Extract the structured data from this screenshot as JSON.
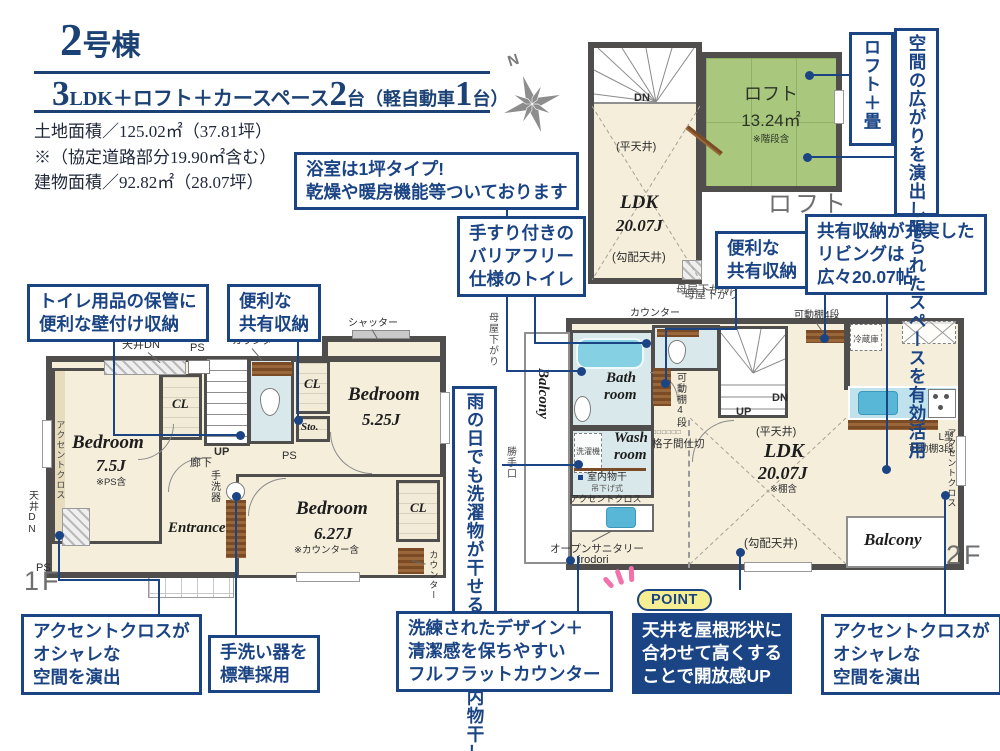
{
  "header": {
    "building_num": "2",
    "building_suffix": "号棟",
    "plan_n1": "3",
    "plan_t1": "LDK＋ロフト＋カースペース",
    "plan_n2": "2",
    "plan_t2": "台（軽自動車",
    "plan_n3": "1",
    "plan_t3": "台）",
    "land_area": "土地面積／125.02㎡（37.81坪）",
    "land_note": "※（協定道路部分19.90㎡含む）",
    "building_area": "建物面積／92.82㎡（28.07坪）"
  },
  "compass": {
    "north": "N"
  },
  "callouts": {
    "bath": {
      "l1": "浴室は1坪タイプ!",
      "l2": "乾燥や暖房機能等ついております"
    },
    "barrier_free": {
      "l1": "手すり付きの",
      "l2": "バリアフリー",
      "l3": "仕様のトイレ"
    },
    "wall_storage": {
      "l1": "トイレ用品の保管に",
      "l2": "便利な壁付け収納"
    },
    "shared_1f": {
      "l1": "便利な",
      "l2": "共有収納"
    },
    "shared_2f": {
      "l1": "便利な",
      "l2": "共有収納"
    },
    "living": {
      "l1": "共有収納が充実した",
      "l2": "リビングは",
      "l3": "広々20.07帖"
    },
    "loft_tatami": {
      "text": "ロフト＋畳"
    },
    "space": {
      "text": "空間の広がりを演出し限られたスペースを有効活用"
    },
    "laundry": {
      "text": "雨の日でも洗濯物が干せる便利な室内物干し"
    },
    "accent_1f": {
      "l1": "アクセントクロスが",
      "l2": "オシャレな",
      "l3": "空間を演出"
    },
    "handwash": {
      "l1": "手洗い器を",
      "l2": "標準採用"
    },
    "flat_counter": {
      "l1": "洗練されたデザイン＋",
      "l2": "清潔感を保ちやすい",
      "l3": "フルフラットカウンター"
    },
    "point": {
      "badge": "POINT",
      "l1": "天井を屋根形状に",
      "l2": "合わせて高くする",
      "l3": "ことで開放感UP"
    },
    "accent_2f": {
      "l1": "アクセントクロスが",
      "l2": "オシャレな",
      "l3": "空間を演出"
    }
  },
  "loft": {
    "dn": "DN",
    "name": "ロフト",
    "area": "13.24㎡",
    "note": "※階段含",
    "flat_ceiling": "(平天井)",
    "ldk": "LDK",
    "ldk_size": "20.07J",
    "slope_ceiling": "(勾配天井)",
    "moyasagari": "母屋下がり",
    "floor_name": "ロフト"
  },
  "f2": {
    "moya_left": "母屋下がり",
    "moya_top": "母屋下がり",
    "katteguchi": "勝手口",
    "balcony_left": "Balcony",
    "bath_l1": "Bath",
    "bath_l2": "room",
    "washer": "洗濯機",
    "wash_l1": "Wash",
    "wash_l2": "room",
    "monohoshi": "室内物干",
    "tsurisage": "吊下げ式",
    "accent_wash": "アクセントクロス",
    "open_sanitary": "オープンサニタリー",
    "irodori": "irodori",
    "counter": "カウンター",
    "kadoudana4_1": "可動棚4段",
    "kadoudana4_2": "可動棚4段",
    "koushi_dots": "□□□□□□",
    "koushi": "格子間仕切",
    "up": "UP",
    "dn": "DN",
    "flat_ceiling": "(平天井)",
    "ldk": "LDK",
    "ldk_size": "20.07J",
    "ldk_note": "※棚含",
    "slope_ceiling": "(勾配天井)",
    "fridge": "冷蔵庫",
    "lshelf_l1": "L型",
    "lshelf_l2": "可動棚3段",
    "accent_right": "アクセントクロス",
    "balcony_bottom": "Balcony",
    "floor_name": "2F"
  },
  "f1": {
    "ceiling_dn_top": "天井DN",
    "ps_top": "PS",
    "counter_top": "カウンター",
    "shutter": "シャッター",
    "cl1": "CL",
    "cl2": "CL",
    "cl3": "CL",
    "sto": "Sto.",
    "bed1": "Bedroom",
    "bed1_size": "7.5J",
    "bed1_note": "※PS含",
    "accent": "アクセントクロス",
    "ceiling_dn_left": "天井DN",
    "ps_left": "PS",
    "up": "UP",
    "hallway": "廊下",
    "ps_mid": "PS",
    "tearaiki": "手洗器",
    "entrance": "Entrance",
    "bed2": "Bedroom",
    "bed2_size": "5.25J",
    "bed3": "Bedroom",
    "bed3_size": "6.27J",
    "bed3_note": "※カウンター含",
    "counter_right": "カウンター",
    "floor_name": "1F"
  },
  "colors": {
    "navy": "#1b4484",
    "wall": "#4f4e4c",
    "room_beige": "#f4eedb",
    "loft_green": "#a9c77d",
    "water_blue": "#d9e8ea",
    "fixture_aqua": "#7fd0e2",
    "wood_brown": "#7b4b26",
    "point_yellow": "#f6ef91",
    "accent_pink": "#f272ab",
    "floor_label_gray": "#6f6f6f"
  }
}
